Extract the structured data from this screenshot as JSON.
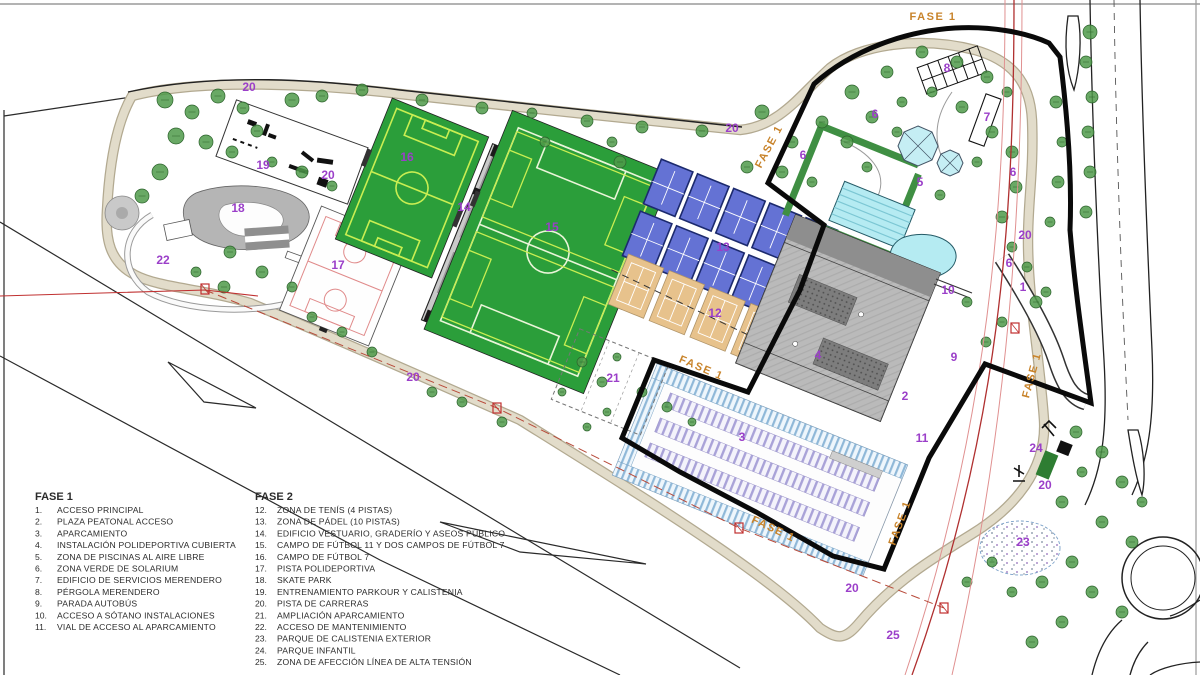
{
  "plan": {
    "phase_boundary_label": "FASE 1",
    "colors": {
      "field_green": "#2b9e3a",
      "field_lines_yellow": "#c9ee52",
      "field_lines_white": "#eaf5d8",
      "padel_blue": "#6472d4",
      "padel_border": "#1c2a6e",
      "tennis_tan": "#e7c28c",
      "pool_cyan": "#b5ebf2",
      "solarium_green": "#3f8f43",
      "building_gray": "#b3b3b3",
      "parking_blue_band": "#8fb8d8",
      "parking_purple_rows": "#a9a2d8",
      "track_beige": "#e2dcca",
      "tree_green": "#4f9a4a",
      "number_purple": "#9b3fc9",
      "fase_orange": "#c8832a",
      "tension_red": "#b03030"
    },
    "phase_labels": [
      {
        "text": "FASE 1",
        "x": 933,
        "y": 20,
        "r": 0
      },
      {
        "text": "FASE 1",
        "x": 772,
        "y": 148,
        "r": -62
      },
      {
        "text": "FASE 1",
        "x": 700,
        "y": 371,
        "r": 23
      },
      {
        "text": "FASE 1",
        "x": 772,
        "y": 532,
        "r": 25
      },
      {
        "text": "FASE 1",
        "x": 903,
        "y": 524,
        "r": -70
      },
      {
        "text": "FASE 1",
        "x": 1035,
        "y": 376,
        "r": -75
      }
    ],
    "number_labels": [
      {
        "t": "1",
        "x": 1023,
        "y": 291
      },
      {
        "t": "2",
        "x": 905,
        "y": 400
      },
      {
        "t": "3",
        "x": 742,
        "y": 441
      },
      {
        "t": "4",
        "x": 818,
        "y": 359
      },
      {
        "t": "5",
        "x": 920,
        "y": 186
      },
      {
        "t": "6",
        "x": 875,
        "y": 118
      },
      {
        "t": "6",
        "x": 803,
        "y": 159
      },
      {
        "t": "6",
        "x": 1013,
        "y": 176
      },
      {
        "t": "6",
        "x": 1009,
        "y": 267
      },
      {
        "t": "7",
        "x": 987,
        "y": 121
      },
      {
        "t": "8",
        "x": 947,
        "y": 72
      },
      {
        "t": "9",
        "x": 954,
        "y": 361
      },
      {
        "t": "10",
        "x": 948,
        "y": 294
      },
      {
        "t": "11",
        "x": 922,
        "y": 442
      },
      {
        "t": "12",
        "x": 715,
        "y": 317
      },
      {
        "t": "13",
        "x": 723,
        "y": 251
      },
      {
        "t": "14",
        "x": 464,
        "y": 211
      },
      {
        "t": "15",
        "x": 552,
        "y": 231
      },
      {
        "t": "16",
        "x": 407,
        "y": 161
      },
      {
        "t": "17",
        "x": 338,
        "y": 269
      },
      {
        "t": "18",
        "x": 238,
        "y": 212
      },
      {
        "t": "19",
        "x": 263,
        "y": 169
      },
      {
        "t": "20",
        "x": 249,
        "y": 91
      },
      {
        "t": "20",
        "x": 328,
        "y": 179
      },
      {
        "t": "20",
        "x": 413,
        "y": 381
      },
      {
        "t": "20",
        "x": 732,
        "y": 132
      },
      {
        "t": "20",
        "x": 1025,
        "y": 239
      },
      {
        "t": "20",
        "x": 1045,
        "y": 489
      },
      {
        "t": "20",
        "x": 852,
        "y": 592
      },
      {
        "t": "21",
        "x": 613,
        "y": 382
      },
      {
        "t": "22",
        "x": 163,
        "y": 264
      },
      {
        "t": "23",
        "x": 1023,
        "y": 546
      },
      {
        "t": "24",
        "x": 1036,
        "y": 452
      },
      {
        "t": "25",
        "x": 893,
        "y": 639
      }
    ],
    "trees": [
      [
        165,
        100,
        8
      ],
      [
        192,
        112,
        7
      ],
      [
        218,
        96,
        7
      ],
      [
        243,
        108,
        6
      ],
      [
        176,
        136,
        8
      ],
      [
        206,
        142,
        7
      ],
      [
        232,
        152,
        6
      ],
      [
        160,
        172,
        8
      ],
      [
        142,
        196,
        7
      ],
      [
        257,
        131,
        6
      ],
      [
        292,
        100,
        7
      ],
      [
        322,
        96,
        6
      ],
      [
        272,
        162,
        5
      ],
      [
        302,
        172,
        6
      ],
      [
        332,
        186,
        5
      ],
      [
        230,
        252,
        6
      ],
      [
        262,
        272,
        6
      ],
      [
        292,
        287,
        5
      ],
      [
        224,
        287,
        6
      ],
      [
        196,
        272,
        5
      ],
      [
        362,
        90,
        6
      ],
      [
        422,
        100,
        6
      ],
      [
        482,
        108,
        6
      ],
      [
        532,
        113,
        5
      ],
      [
        587,
        121,
        6
      ],
      [
        642,
        127,
        6
      ],
      [
        702,
        131,
        6
      ],
      [
        545,
        142,
        5
      ],
      [
        612,
        142,
        5
      ],
      [
        620,
        162,
        6
      ],
      [
        762,
        112,
        7
      ],
      [
        792,
        142,
        6
      ],
      [
        782,
        172,
        6
      ],
      [
        812,
        182,
        5
      ],
      [
        747,
        167,
        6
      ],
      [
        822,
        122,
        6
      ],
      [
        852,
        92,
        7
      ],
      [
        887,
        72,
        6
      ],
      [
        922,
        52,
        6
      ],
      [
        957,
        62,
        6
      ],
      [
        987,
        77,
        6
      ],
      [
        1007,
        92,
        5
      ],
      [
        872,
        117,
        6
      ],
      [
        902,
        102,
        5
      ],
      [
        932,
        92,
        5
      ],
      [
        847,
        142,
        6
      ],
      [
        867,
        167,
        5
      ],
      [
        897,
        132,
        5
      ],
      [
        962,
        107,
        6
      ],
      [
        992,
        132,
        6
      ],
      [
        1012,
        152,
        6
      ],
      [
        1016,
        187,
        6
      ],
      [
        1002,
        217,
        6
      ],
      [
        977,
        162,
        5
      ],
      [
        940,
        195,
        5
      ],
      [
        1056,
        102,
        6
      ],
      [
        1062,
        142,
        5
      ],
      [
        1058,
        182,
        6
      ],
      [
        1050,
        222,
        5
      ],
      [
        1090,
        32,
        7
      ],
      [
        1086,
        62,
        6
      ],
      [
        1092,
        97,
        6
      ],
      [
        1088,
        132,
        6
      ],
      [
        1090,
        172,
        6
      ],
      [
        1086,
        212,
        6
      ],
      [
        1036,
        302,
        6
      ],
      [
        1002,
        322,
        5
      ],
      [
        967,
        302,
        5
      ],
      [
        986,
        342,
        5
      ],
      [
        1012,
        247,
        5
      ],
      [
        1027,
        267,
        5
      ],
      [
        1046,
        292,
        5
      ],
      [
        1076,
        432,
        6
      ],
      [
        1102,
        452,
        6
      ],
      [
        1122,
        482,
        6
      ],
      [
        1082,
        472,
        5
      ],
      [
        1062,
        502,
        6
      ],
      [
        1102,
        522,
        6
      ],
      [
        1132,
        542,
        6
      ],
      [
        1072,
        562,
        6
      ],
      [
        1042,
        582,
        6
      ],
      [
        1012,
        592,
        5
      ],
      [
        1092,
        592,
        6
      ],
      [
        1122,
        612,
        6
      ],
      [
        1062,
        622,
        6
      ],
      [
        1032,
        642,
        6
      ],
      [
        992,
        562,
        5
      ],
      [
        967,
        582,
        5
      ],
      [
        1142,
        502,
        5
      ],
      [
        642,
        392,
        5
      ],
      [
        667,
        407,
        5
      ],
      [
        692,
        422,
        4
      ],
      [
        602,
        382,
        5
      ],
      [
        582,
        362,
        5
      ],
      [
        617,
        357,
        4
      ],
      [
        562,
        392,
        4
      ],
      [
        607,
        412,
        4
      ],
      [
        587,
        427,
        4
      ],
      [
        462,
        402,
        5
      ],
      [
        432,
        392,
        5
      ],
      [
        502,
        422,
        5
      ],
      [
        372,
        352,
        5
      ],
      [
        342,
        332,
        5
      ],
      [
        312,
        317,
        5
      ]
    ],
    "red_markers": [
      [
        205,
        289
      ],
      [
        497,
        408
      ],
      [
        739,
        528
      ],
      [
        944,
        608
      ],
      [
        1015,
        328
      ]
    ]
  },
  "legend": {
    "fase1": {
      "header": "FASE 1",
      "items": [
        {
          "num": "1.",
          "label": "ACCESO PRINCIPAL"
        },
        {
          "num": "2.",
          "label": "PLAZA PEATONAL ACCESO"
        },
        {
          "num": "3.",
          "label": "APARCAMIENTO"
        },
        {
          "num": "4.",
          "label": "INSTALACIÓN POLIDEPORTIVA CUBIERTA"
        },
        {
          "num": "5.",
          "label": "ZONA DE PISCINAS AL AIRE LIBRE"
        },
        {
          "num": "6.",
          "label": "ZONA VERDE DE SOLARIUM"
        },
        {
          "num": "7.",
          "label": "EDIFICIO DE SERVICIOS MERENDERO"
        },
        {
          "num": "8.",
          "label": "PÉRGOLA MERENDERO"
        },
        {
          "num": "9.",
          "label": "PARADA AUTOBÚS"
        },
        {
          "num": "10.",
          "label": "ACCESO A SÓTANO INSTALACIONES"
        },
        {
          "num": "11.",
          "label": "VIAL DE ACCESO AL APARCAMIENTO"
        }
      ]
    },
    "fase2": {
      "header": "FASE 2",
      "items": [
        {
          "num": "12.",
          "label": "ZONA DE TENÍS (4 PISTAS)"
        },
        {
          "num": "13.",
          "label": "ZONA DE PÁDEL (10 PISTAS)"
        },
        {
          "num": "14.",
          "label": "EDIFICIO VESTUARIO, GRADERÍO Y ASEOS PÚBLICO"
        },
        {
          "num": "15.",
          "label": "CAMPO DE FÚTBOL 11 Y DOS CAMPOS DE FÚTBOL 7"
        },
        {
          "num": "16.",
          "label": "CAMPO DE FÚTBOL 7"
        },
        {
          "num": "17.",
          "label": "PISTA POLIDEPORTIVA"
        },
        {
          "num": "18.",
          "label": "SKATE PARK"
        },
        {
          "num": "19.",
          "label": "ENTRENAMIENTO PARKOUR Y CALISTENIA"
        },
        {
          "num": "20.",
          "label": "PISTA DE CARRERAS"
        },
        {
          "num": "21.",
          "label": "AMPLIACIÓN APARCAMIENTO"
        },
        {
          "num": "22.",
          "label": "ACCESO DE MANTENIMIENTO"
        },
        {
          "num": "23.",
          "label": "PARQUE DE CALISTENIA EXTERIOR"
        },
        {
          "num": "24.",
          "label": "PARQUE INFANTIL"
        },
        {
          "num": "25.",
          "label": "ZONA DE AFECCIÓN LÍNEA DE ALTA TENSIÓN"
        }
      ]
    }
  }
}
